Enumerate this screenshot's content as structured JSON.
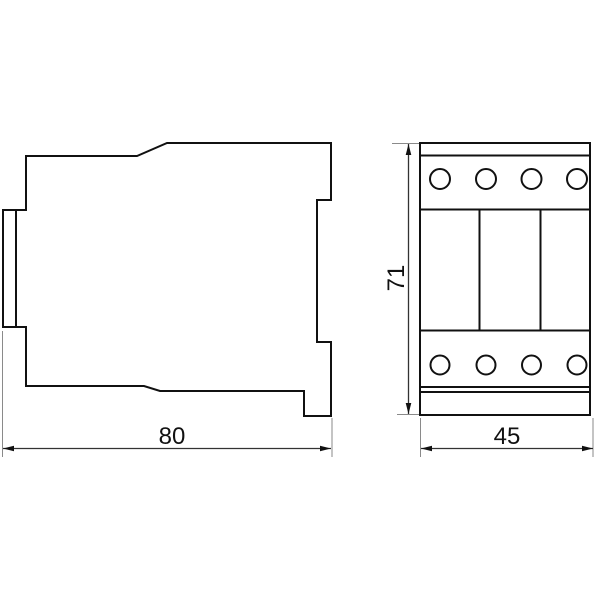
{
  "drawing": {
    "description": "Technical dimensional drawing of a contactor: side profile view and front view",
    "background_color": "#ffffff",
    "outline_color": "#111111",
    "extension_line_color": "#8a8a8a",
    "dimension_line_color": "#333333",
    "side_view": {
      "width_label": "80"
    },
    "front_view": {
      "height_label": "71",
      "width_label": "45",
      "terminal_holes_top": 4,
      "terminal_holes_bottom": 4,
      "pole_dividers": 2
    }
  }
}
